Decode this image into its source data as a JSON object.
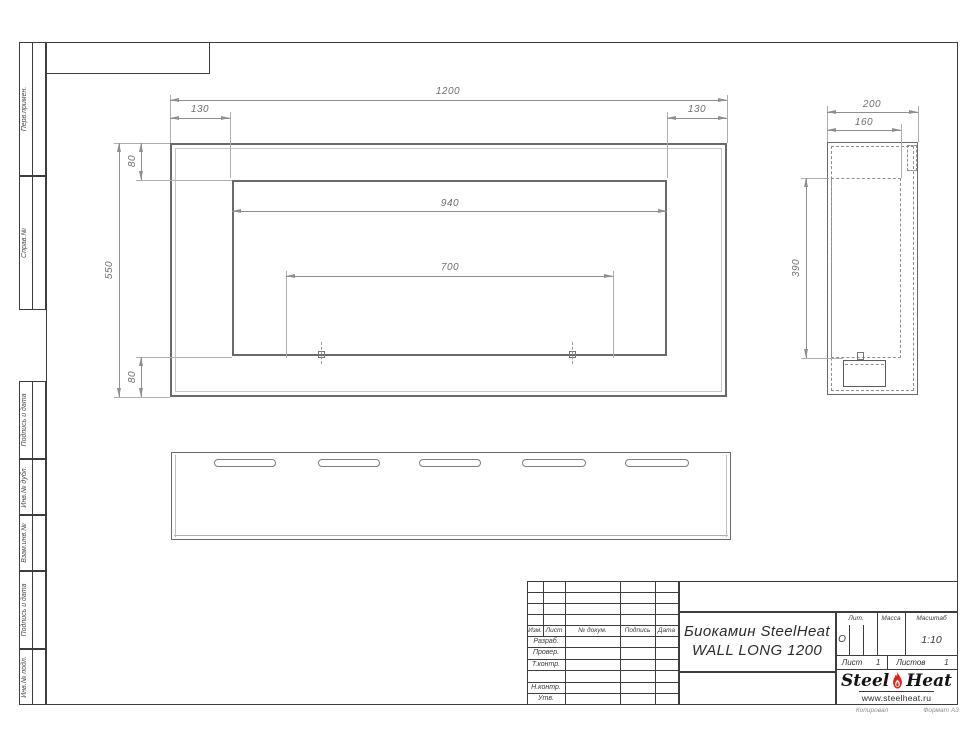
{
  "drawing": {
    "stamp_column": {
      "top_blocks": [
        "Перв.примен.",
        "Справ.№"
      ],
      "bottom_blocks": [
        "Подпись и дата",
        "Инв.№ дубл.",
        "Взам.инв.№",
        "Подпись и дата",
        "Инв.№ подл."
      ]
    },
    "views": {
      "front": {
        "overall_width": "1200",
        "left_offset": "130",
        "right_offset": "130",
        "top_offset": "80",
        "overall_height": "550",
        "bottom_offset": "80",
        "opening_width": "940",
        "inner_span": "700"
      },
      "side": {
        "depth": "200",
        "inner_depth": "160",
        "inner_height": "390"
      }
    },
    "title_block": {
      "cols": {
        "izm": "Изм.",
        "list": "Лист",
        "doc": "№ докум.",
        "sign": "Подпись",
        "date": "Дата"
      },
      "rows": {
        "developed": "Разраб.",
        "checked": "Провер.",
        "t_control": "Т.контр.",
        "n_control": "Н.контр.",
        "approved": "Утв."
      },
      "product_line1": "Биокамин SteelHeat",
      "product_line2": "WALL LONG 1200",
      "lit_label": "Лит.",
      "lit_value": "О",
      "mass_label": "Масса",
      "scale_label": "Масштаб",
      "scale_value": "1:10",
      "sheet_label": "Лист",
      "sheet_number": "1",
      "sheets_label": "Листов",
      "sheets_total": "1",
      "logo": {
        "word1": "Steel",
        "word2": "Heat",
        "site": "www.steelheat.ru",
        "flame_color": "#e2231a"
      }
    },
    "footer": {
      "copied": "Копировал",
      "format": "Формат А3"
    }
  }
}
